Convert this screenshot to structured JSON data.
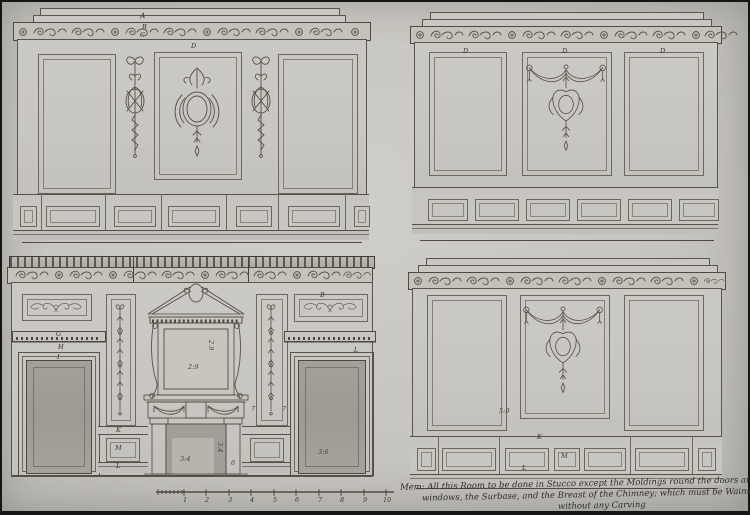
{
  "tl": {
    "a": "A",
    "b": "B",
    "c": "C",
    "d": "D"
  },
  "tr": {
    "d1": "D",
    "d2": "D",
    "d3": "D"
  },
  "bl": {
    "g": "G",
    "h": "H",
    "i": "I",
    "b": "B",
    "k": "K",
    "m": "M",
    "l": "L",
    "l2": "L",
    "seven_a": "7",
    "seven_b": "7",
    "dim_overmantel_v": "2.9",
    "dim_overmantel_h": "2:9",
    "dim_opening_h": "3:4",
    "dim_opening_v": "3.4",
    "dim_six": "6",
    "dim_right_door": "3:6"
  },
  "br": {
    "k": "K",
    "m": "M",
    "l": "L",
    "dim_panel": "5:9"
  },
  "scale_bar": {
    "ticks": [
      "1",
      "2",
      "3",
      "4",
      "5",
      "6",
      "7",
      "8",
      "9",
      "10"
    ]
  },
  "inscription": {
    "line1": "Mem: All this Room to be done in Stucco except the Moldings round the doors and",
    "line2": "windows, the Surbase, and the Breast of the Chimney; which must be Wainscot",
    "line3": "without any Carving"
  },
  "colors": {
    "paper": "#c7c5bf",
    "ink": "#4e4a43",
    "wash": "#9d9a93"
  }
}
